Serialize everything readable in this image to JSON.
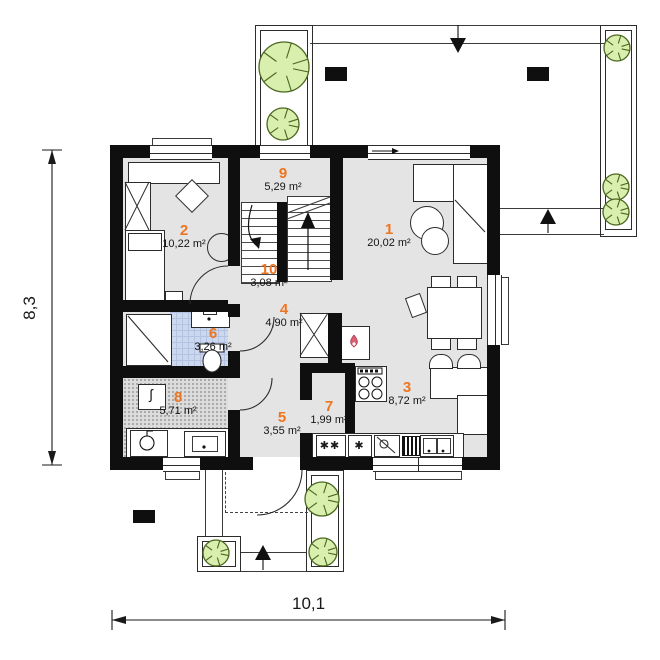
{
  "plan": {
    "type": "floor-plan",
    "dimension_labels": {
      "height": "8,3",
      "width": "10,1"
    },
    "rooms": [
      {
        "number": "1",
        "area": "20,02 m²"
      },
      {
        "number": "2",
        "area": "10,22 m²"
      },
      {
        "number": "3",
        "area": "8,72 m²"
      },
      {
        "number": "4",
        "area": "4,90 m²"
      },
      {
        "number": "5",
        "area": "3,55 m²"
      },
      {
        "number": "6",
        "area": "3,26 m²"
      },
      {
        "number": "7",
        "area": "1,99 m²"
      },
      {
        "number": "8",
        "area": "5,71 m²"
      },
      {
        "number": "9",
        "area": "5,29 m²"
      },
      {
        "number": "10",
        "area": "3,08 m²"
      }
    ],
    "symbols": {
      "laundry_double": "✱✱",
      "laundry_single": "✱",
      "boiler": "ʃ"
    },
    "colors": {
      "accent_number": "#ee7520",
      "wall": "#0f0f0f",
      "floor": "#e4e4e4",
      "bathroom_floor": "#ccd8ee",
      "utility_floor": "#dcdcdc",
      "tree_fill": "#d9efae",
      "tree_stroke": "#4a661f",
      "flame": "#d95f72"
    }
  }
}
